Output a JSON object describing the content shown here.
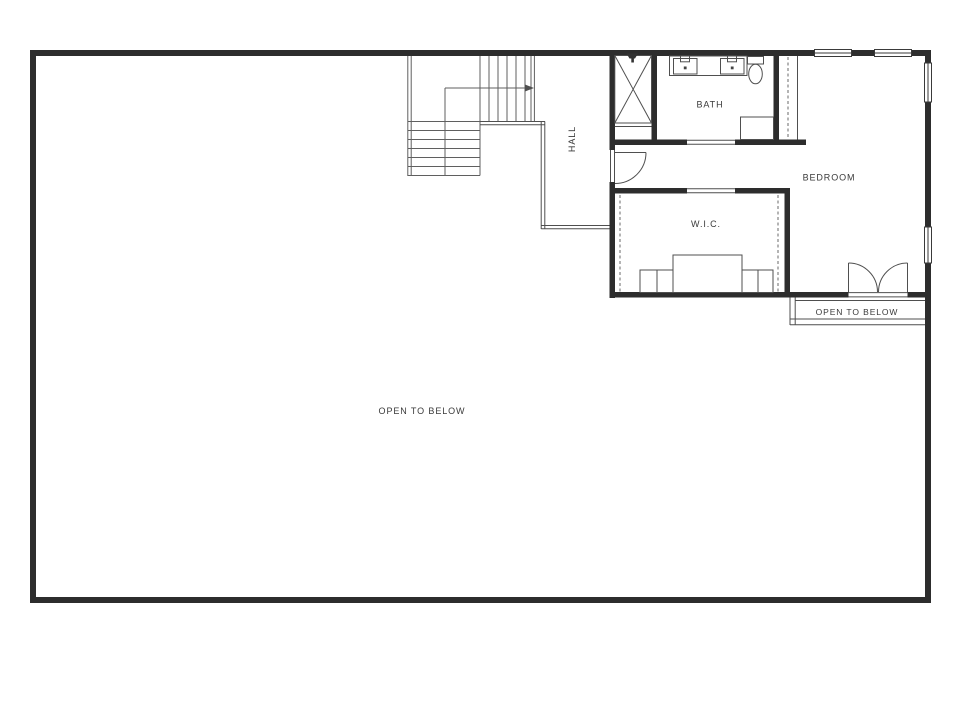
{
  "labels": {
    "hall": "HALL",
    "bath": "BATH",
    "bedroom": "BEDROOM",
    "wic": "W.I.C.",
    "open_to_below_right": "OPEN TO BELOW",
    "open_to_below_main": "OPEN TO BELOW"
  },
  "colors": {
    "wall": "#2d2d2d",
    "thin_line": "#4f4f4f",
    "stair_line": "#5f5f5f",
    "dashed_line": "#6a6a6a",
    "text": "#3a3a3a",
    "background": "#ffffff"
  }
}
